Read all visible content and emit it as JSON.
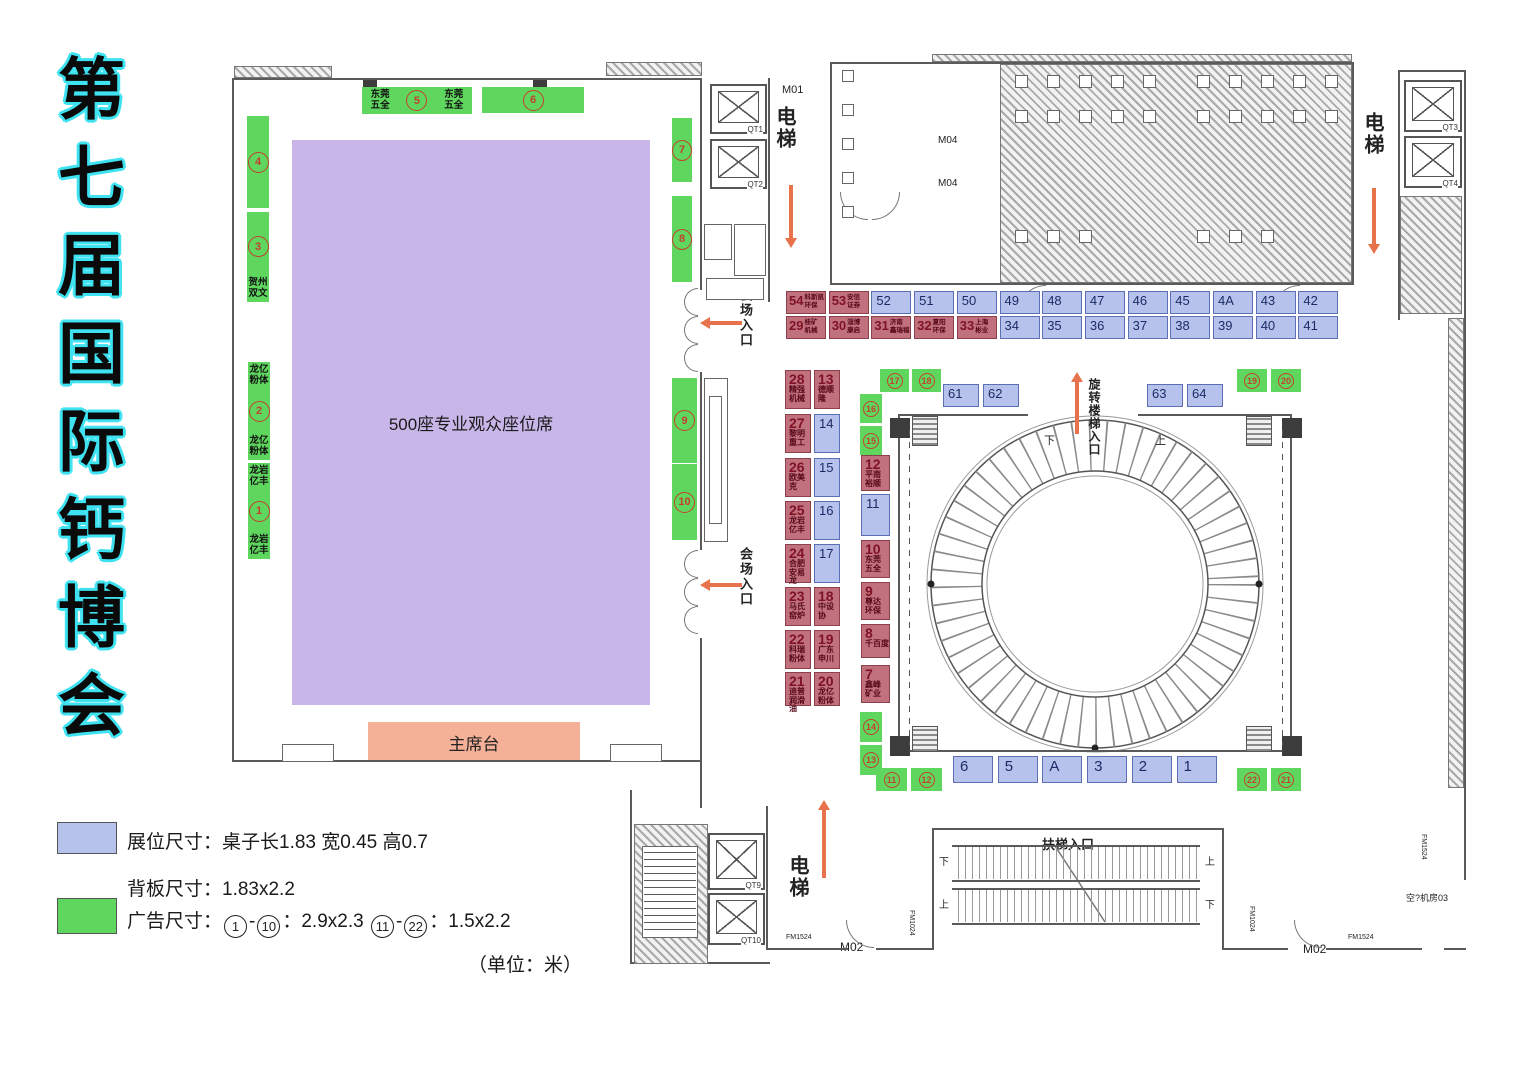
{
  "title": {
    "text": "第七届国际钙博会"
  },
  "hall": {
    "seating": "500座专业观众座位席",
    "stage": "主席台"
  },
  "entrances": {
    "venue": "会场入口",
    "spiral": "旋转楼梯入口",
    "escalator": "扶梯入口"
  },
  "elevator_label": "电梯",
  "updown": {
    "up": "上",
    "down": "下"
  },
  "rooms": {
    "m01": "M01",
    "m02": "M02",
    "m04": "M04",
    "reception2": "??接待室2",
    "reception1": "??接待室1L",
    "stairs": "3#楼梯",
    "machine": "空?机房03",
    "rd": "RD",
    "qd": "QD",
    "py": "PY"
  },
  "elevators": [
    {
      "id": "QT1",
      "x": 710,
      "y": 84,
      "w": 57,
      "h": 50
    },
    {
      "id": "QT2",
      "x": 710,
      "y": 139,
      "w": 57,
      "h": 50
    },
    {
      "id": "QT3",
      "x": 1404,
      "y": 80,
      "w": 58,
      "h": 52
    },
    {
      "id": "QT4",
      "x": 1404,
      "y": 136,
      "w": 58,
      "h": 52
    },
    {
      "id": "QT9",
      "x": 708,
      "y": 833,
      "w": 57,
      "h": 57
    },
    {
      "id": "QT10",
      "x": 708,
      "y": 893,
      "w": 57,
      "h": 52
    }
  ],
  "fm": {
    "fm1024": "FM1024",
    "fm1524": "FM1524"
  },
  "legend": {
    "booth_line": "展位尺寸：桌子长1.83 宽0.45 高0.7",
    "back_line": "背板尺寸：1.83x2.2",
    "ad_prefix": "广告尺寸：",
    "ad_n1": "1",
    "ad_dash1": "-",
    "ad_n2": "10",
    "ad_mid": "：2.9x2.3",
    "ad_n3": "11",
    "ad_dash2": "-",
    "ad_n4": "22",
    "ad_suffix": "：1.5x2.2",
    "unit": "（单位：米）"
  },
  "banners": [
    {
      "num": "1",
      "rect": [
        248,
        463,
        22,
        96
      ],
      "text_top": "龙岩亿丰",
      "text_bottom": "龙岩亿丰"
    },
    {
      "num": "2",
      "rect": [
        248,
        362,
        22,
        98
      ],
      "text_top": "龙亿粉体",
      "text_bottom": "龙亿粉体"
    },
    {
      "num": "3",
      "rect": [
        247,
        212,
        22,
        90
      ],
      "text_bottom": "贺州双文"
    },
    {
      "num": "4",
      "rect": [
        247,
        116,
        22,
        92
      ]
    },
    {
      "num": "5",
      "rect": [
        362,
        87,
        110,
        27
      ],
      "text_left": "东莞五全",
      "text_right": "东莞五全"
    },
    {
      "num": "6",
      "rect": [
        482,
        87,
        102,
        26
      ]
    },
    {
      "num": "7",
      "rect": [
        672,
        118,
        20,
        64
      ]
    },
    {
      "num": "8",
      "rect": [
        672,
        196,
        20,
        86
      ]
    },
    {
      "num": "9",
      "rect": [
        672,
        378,
        25,
        85
      ]
    },
    {
      "num": "10",
      "rect": [
        672,
        464,
        25,
        76
      ]
    }
  ],
  "small_ads": [
    {
      "num": "17",
      "rect": [
        880,
        369,
        29,
        23
      ]
    },
    {
      "num": "18",
      "rect": [
        912,
        369,
        29,
        23
      ]
    },
    {
      "num": "16",
      "rect": [
        860,
        394,
        22,
        29
      ]
    },
    {
      "num": "15",
      "rect": [
        860,
        426,
        22,
        29
      ]
    },
    {
      "num": "14",
      "rect": [
        860,
        712,
        22,
        30
      ]
    },
    {
      "num": "13",
      "rect": [
        860,
        745,
        22,
        30
      ]
    },
    {
      "num": "11",
      "rect": [
        876,
        768,
        31,
        23
      ]
    },
    {
      "num": "12",
      "rect": [
        911,
        768,
        31,
        23
      ]
    },
    {
      "num": "19",
      "rect": [
        1237,
        369,
        30,
        23
      ]
    },
    {
      "num": "20",
      "rect": [
        1271,
        369,
        30,
        23
      ]
    },
    {
      "num": "22",
      "rect": [
        1237,
        768,
        30,
        23
      ]
    },
    {
      "num": "21",
      "rect": [
        1271,
        768,
        30,
        23
      ]
    }
  ],
  "booth_row_top": [
    {
      "num": "54",
      "type": "red",
      "name": [
        "科斯凯",
        "环保"
      ]
    },
    {
      "num": "53",
      "type": "red",
      "name": [
        "安信",
        "证券"
      ]
    },
    {
      "num": "52",
      "type": "blue"
    },
    {
      "num": "51",
      "type": "blue"
    },
    {
      "num": "50",
      "type": "blue"
    },
    {
      "num": "49",
      "type": "blue"
    },
    {
      "num": "48",
      "type": "blue"
    },
    {
      "num": "47",
      "type": "blue"
    },
    {
      "num": "46",
      "type": "blue"
    },
    {
      "num": "45",
      "type": "blue"
    },
    {
      "num": "4A",
      "type": "blue"
    },
    {
      "num": "43",
      "type": "blue"
    },
    {
      "num": "42",
      "type": "blue"
    }
  ],
  "booth_row_bottom": [
    {
      "num": "29",
      "type": "red",
      "name": [
        "桂矿",
        "机械"
      ]
    },
    {
      "num": "30",
      "type": "red",
      "name": [
        "淄博",
        "康启"
      ]
    },
    {
      "num": "31",
      "type": "red",
      "name": [
        "济南",
        "鑫瑞福"
      ]
    },
    {
      "num": "32",
      "type": "red",
      "name": [
        "夏阳",
        "环保"
      ]
    },
    {
      "num": "33",
      "type": "red",
      "name": [
        "上海",
        "彬业"
      ]
    },
    {
      "num": "34",
      "type": "blue"
    },
    {
      "num": "35",
      "type": "blue"
    },
    {
      "num": "36",
      "type": "blue"
    },
    {
      "num": "37",
      "type": "blue"
    },
    {
      "num": "38",
      "type": "blue"
    },
    {
      "num": "39",
      "type": "blue"
    },
    {
      "num": "40",
      "type": "blue"
    },
    {
      "num": "41",
      "type": "blue"
    }
  ],
  "col_a": [
    {
      "num": "28",
      "type": "red",
      "name": [
        "精强",
        "机械"
      ]
    },
    {
      "num": "27",
      "type": "red",
      "name": [
        "黎明",
        "重工"
      ]
    },
    {
      "num": "26",
      "type": "red",
      "name": [
        "欧美克"
      ]
    },
    {
      "num": "25",
      "type": "red",
      "name": [
        "龙岩",
        "亿丰"
      ]
    },
    {
      "num": "24",
      "type": "red",
      "name": [
        "合肥",
        "安易龙"
      ]
    },
    {
      "num": "23",
      "type": "red",
      "name": [
        "马氏",
        "窑炉"
      ]
    },
    {
      "num": "22",
      "type": "red",
      "name": [
        "科瑞",
        "粉体"
      ]
    },
    {
      "num": "21",
      "type": "red",
      "name": [
        "迪普",
        "润滑油"
      ]
    }
  ],
  "col_b": [
    {
      "num": "13",
      "type": "red",
      "name": [
        "德顺隆"
      ]
    },
    {
      "num": "14",
      "type": "blue"
    },
    {
      "num": "15",
      "type": "blue"
    },
    {
      "num": "16",
      "type": "blue"
    },
    {
      "num": "17",
      "type": "blue"
    },
    {
      "num": "18",
      "type": "red",
      "name": [
        "中设协"
      ]
    },
    {
      "num": "19",
      "type": "red",
      "name": [
        "广东",
        "申川"
      ]
    },
    {
      "num": "20",
      "type": "red",
      "name": [
        "龙亿",
        "粉体"
      ]
    }
  ],
  "col_c": [
    {
      "num": "12",
      "type": "red",
      "name": [
        "平南",
        "裕顺"
      ]
    },
    {
      "num": "11",
      "type": "blue"
    },
    {
      "num": "10",
      "type": "red",
      "name": [
        "东莞",
        "五全"
      ]
    },
    {
      "num": "9",
      "type": "red",
      "name": [
        "尊达",
        "环保"
      ]
    },
    {
      "num": "8",
      "type": "red",
      "name": [
        "千百度"
      ]
    },
    {
      "num": "7",
      "type": "red",
      "name": [
        "鑫峰",
        "矿业"
      ]
    }
  ],
  "circle_booths_top_left": [
    "61",
    "62"
  ],
  "circle_booths_top_right": [
    "63",
    "64"
  ],
  "circle_booths_bottom": [
    "6",
    "5",
    "A",
    "3",
    "2",
    "1"
  ]
}
